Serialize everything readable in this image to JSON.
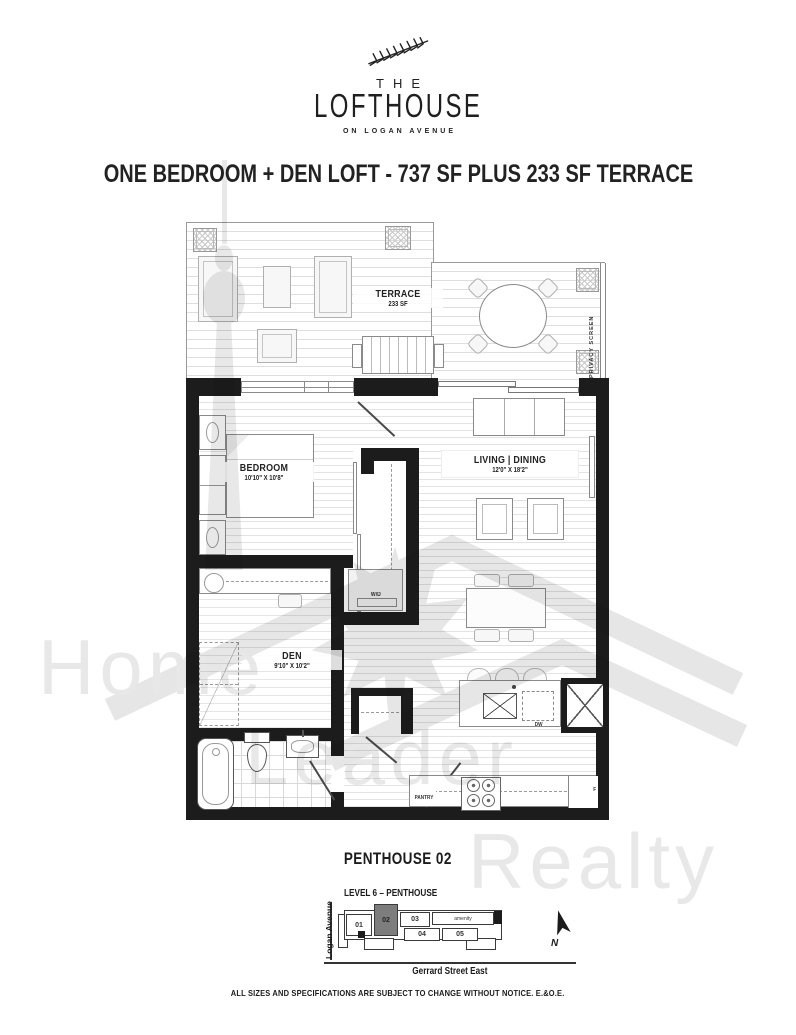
{
  "logo": {
    "prefix": "THE",
    "name": "LOFTHOUSE",
    "tagline": "ON LOGAN AVENUE"
  },
  "title": "ONE BEDROOM + DEN LOFT - 737 SF PLUS 233 SF TERRACE",
  "plan": {
    "terrace": {
      "name": "TERRACE",
      "size": "233 SF",
      "privacy_screen": "PRIVACY SCREEN"
    },
    "bedroom": {
      "name": "BEDROOM",
      "dims": "10'10\" X 10'8\""
    },
    "living": {
      "name": "LIVING | DINING",
      "dims": "12'0\" X 18'2\""
    },
    "den": {
      "name": "DEN",
      "dims": "9'10\" X 10'2\""
    },
    "fixtures": {
      "washer_dryer": "W/D",
      "dishwasher": "DW",
      "fridge": "F",
      "pantry": "PANTRY"
    }
  },
  "unit_name": "PENTHOUSE 02",
  "keyplan": {
    "level": "LEVEL 6 – PENTHOUSE",
    "street_left": "Logan Avenue",
    "street_bottom": "Gerrard Street East",
    "amenity": "amenity",
    "north": "N",
    "units": [
      {
        "id": "01",
        "highlighted": false
      },
      {
        "id": "02",
        "highlighted": true
      },
      {
        "id": "03",
        "highlighted": false
      },
      {
        "id": "04",
        "highlighted": false
      },
      {
        "id": "05",
        "highlighted": false
      }
    ]
  },
  "watermark": {
    "words": [
      "Home",
      "Leader",
      "Realty"
    ]
  },
  "footer": "ALL SIZES AND SPECIFICATIONS ARE SUBJECT TO CHANGE WITHOUT NOTICE. E.&O.E.",
  "colors": {
    "wall": "#1c1c1c",
    "highlighted_unit": "#7d7d7d",
    "floor_line": "#e3e3e3",
    "watermark": "#dadada"
  }
}
